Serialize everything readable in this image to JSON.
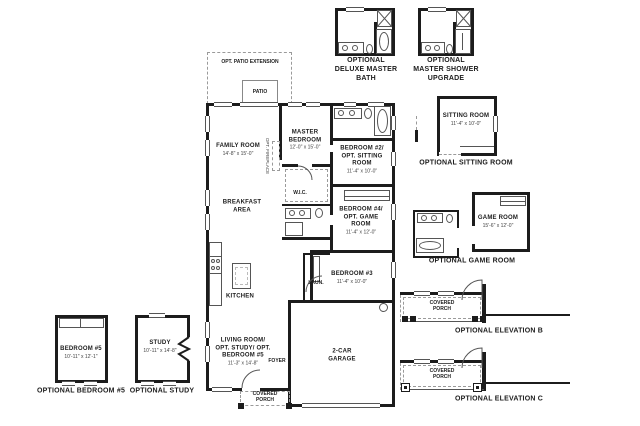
{
  "colors": {
    "wall": "#1c1c1c",
    "line": "#555555",
    "dash": "#9a9a9a",
    "bg": "#ffffff"
  },
  "top_insets": {
    "deluxe_bath_caption": "OPTIONAL DELUXE MASTER BATH",
    "shower_upgrade_caption": "OPTIONAL MASTER SHOWER UPGRADE"
  },
  "main": {
    "opt_patio": "OPT. PATIO EXTENSION",
    "patio": "PATIO",
    "family_room": {
      "name": "FAMILY ROOM",
      "dims": "14'-8\" x 15'-0\""
    },
    "opt_fireplace": "OPT. FIREPLACE",
    "master_bedroom": {
      "name": "MASTER BEDROOM",
      "dims": "12'-0\" x 15'-0\""
    },
    "bedroom2": {
      "name": "BEDROOM #2/ OPT. SITTING ROOM",
      "dims": "11'-4\" x 10'-0\""
    },
    "wic": "W.I.C.",
    "breakfast": "BREAKFAST AREA",
    "bedroom4": {
      "name": "BEDROOM #4/ OPT. GAME ROOM",
      "dims": "11'-4\" x 12'-0\""
    },
    "kitchen": "KITCHEN",
    "laundry": "LAUN.",
    "bedroom3": {
      "name": "BEDROOM #3",
      "dims": "11'-4\" x 10'-0\""
    },
    "living_room": {
      "name": "LIVING ROOM/ OPT. STUDY/ OPT. BEDROOM #5",
      "dims": "11'-3\" x 14'-8\""
    },
    "foyer": "FOYER",
    "garage": "2-CAR GARAGE",
    "porch": "COVERED PORCH"
  },
  "right_insets": {
    "sitting": {
      "name": "SITTING ROOM",
      "dims": "11'-4\" x 10'-0\"",
      "caption": "OPTIONAL SITTING ROOM"
    },
    "game": {
      "name": "GAME ROOM",
      "dims": "15'-6\" x 12'-0\"",
      "caption": "OPTIONAL GAME ROOM"
    },
    "elev_b": {
      "porch": "COVERED PORCH",
      "caption": "OPTIONAL ELEVATION B"
    },
    "elev_c": {
      "porch": "COVERED PORCH",
      "caption": "OPTIONAL ELEVATION C"
    }
  },
  "left_insets": {
    "bedroom5": {
      "name": "BEDROOM #5",
      "dims": "10'-11\" x 12'-1\"",
      "caption": "OPTIONAL BEDROOM #5"
    },
    "study": {
      "name": "STUDY",
      "dims": "10'-11\" x 14'-8\"",
      "caption": "OPTIONAL STUDY"
    }
  }
}
